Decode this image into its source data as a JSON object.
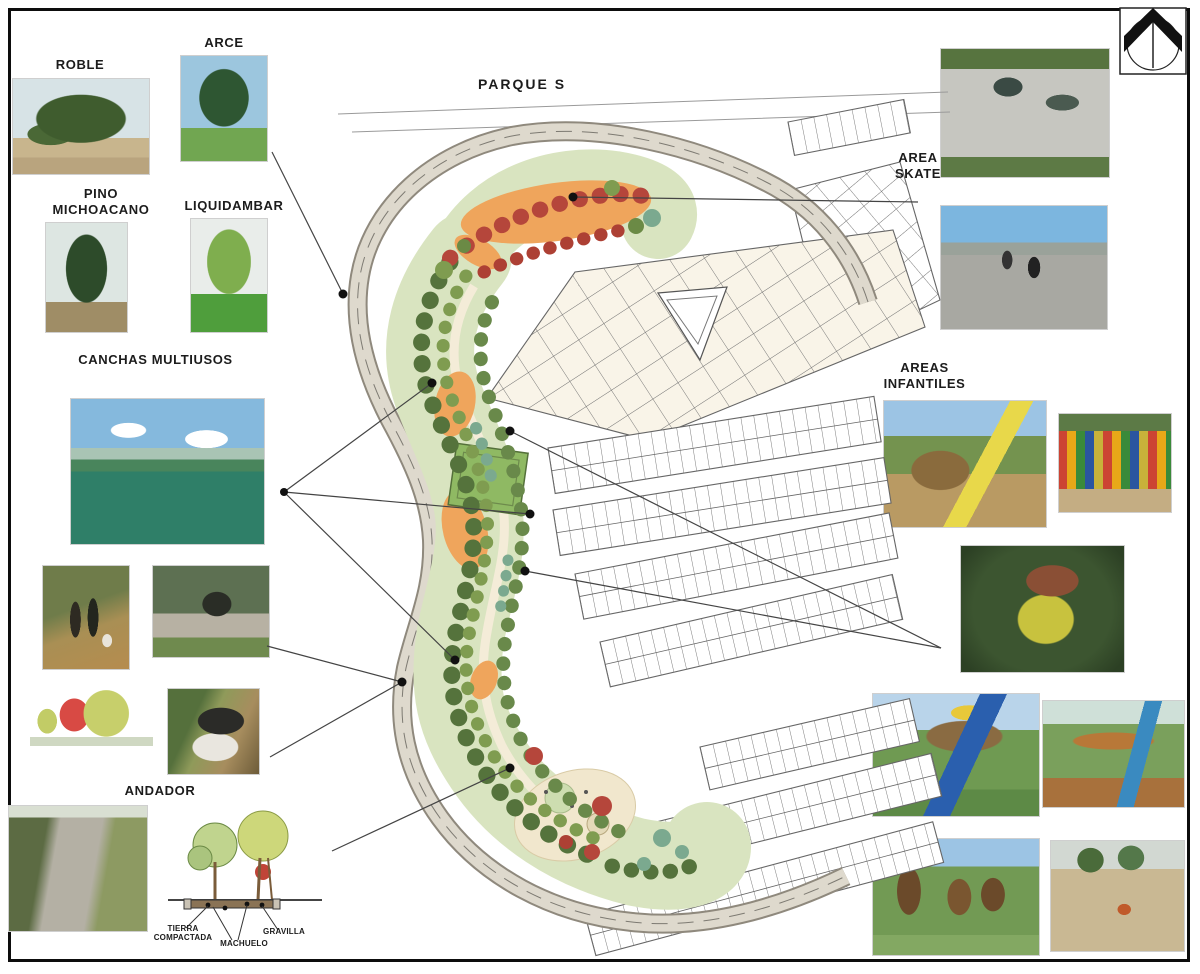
{
  "board": {
    "title": "PARQUE S"
  },
  "tree_legend": {
    "roble": "ROBLE",
    "arce": "ARCE",
    "pino": "PINO MICHOACANO",
    "liquidambar": "LIQUIDAMBAR"
  },
  "amenity_labels": {
    "canchas": "CANCHAS MULTIUSOS",
    "andador": "ANDADOR",
    "area_skate": "AREA SKATE",
    "areas_infantiles": "AREAS INFANTILES"
  },
  "section_labels": {
    "tierra": "TIERRA COMPACTADA",
    "machuelo": "MACHUELO",
    "gravilla": "GRAVILLA"
  },
  "icons": {
    "compass": "north-arrow-icon"
  },
  "photos": {
    "roble": "oak-tree-photo",
    "arce": "maple-tree-photo",
    "pino": "michoacan-pine-photo",
    "liquidambar": "sweetgum-tree-photo",
    "canchas": "multiuse-court-photo",
    "walkers": "people-walking-dogs-photo",
    "cyclist": "woman-cycling-photo",
    "picnic_sketch": "picnic-tables-sketch",
    "stroller": "stroller-on-path-photo",
    "path": "gravel-walkway-photo",
    "skate_overview": "skatepark-overview-photo",
    "skate_action": "skatepark-action-photo",
    "playground_castle": "wood-castle-playground-photo",
    "playground_palisade": "colorful-palisade-playground-photo",
    "playground_forest": "forest-playhouse-photo",
    "playground_blue_slide": "playset-blue-slide-photo",
    "playground_swings": "swingset-slide-photo",
    "playground_towers": "wood-towers-playground-photo",
    "playground_plaza": "sand-playground-plaza-photo"
  },
  "plan_colors": {
    "tree_green": "#55733c",
    "tree_red": "#b5463b",
    "sand_orange": "#efa55c",
    "road_gray": "#ded9cd",
    "court_green": "#8fb963",
    "lawn_green": "#d9e4c0"
  }
}
